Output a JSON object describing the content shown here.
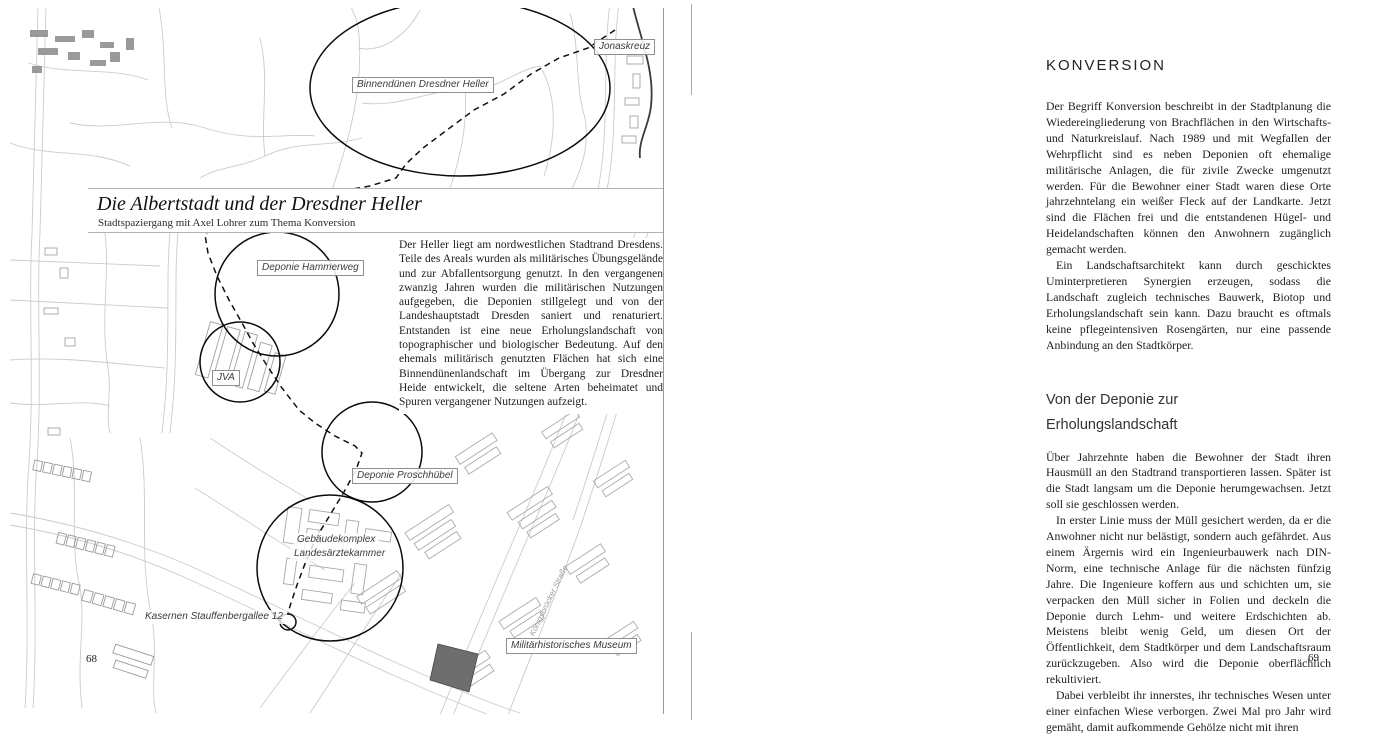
{
  "book": {
    "left_page": {
      "page_number": "68",
      "title": "Die Albertstadt und der Dresdner Heller",
      "subtitle": "Stadtspaziergang mit Axel Lohrer zum Thema Konversion",
      "intro": "Der Heller liegt am nordwestlichen Stadtrand Dresdens. Teile des Areals wurden als militärisches Übungsgelände und zur Abfallentsorgung genutzt. In den vergangenen zwanzig Jahren wurden die militärischen Nutzungen aufgegeben, die Deponien stillgelegt und von der Landeshauptstadt Dresden saniert und renaturiert. Entstanden ist eine neue Erholungslandschaft von topographischer und biologischer Bedeutung. Auf den ehemals militärisch genutzten Flächen hat sich eine Binnendünenlandschaft im Übergang zur Dresdner Heide entwickelt, die seltene Arten beheimatet und Spuren vergangener Nutzungen aufzeigt.",
      "map": {
        "labels": [
          {
            "text": "Jonaskreuz"
          },
          {
            "text": "Binnendünen Dresdner Heller"
          },
          {
            "text": "Deponie Hammerweg"
          },
          {
            "text": "JVA"
          },
          {
            "text": "Deponie Proschhübel"
          },
          {
            "text": "Gebäudekomplex"
          },
          {
            "text": "Landesärztekammer"
          },
          {
            "text": "Kasernen Stauffenbergallee 12"
          },
          {
            "text": "Militärhistorisches Museum"
          }
        ],
        "street_label": "Königsbrücker Straße"
      }
    },
    "right_page": {
      "page_number": "69",
      "section1": {
        "heading": "KONVERSION",
        "paragraphs": [
          "Der Begriff Konversion beschreibt in der Stadtplanung die Wiedereingliederung von Brachflächen in den Wirtschafts- und Naturkreislauf. Nach 1989 und mit Wegfallen der Wehrpflicht sind es neben Deponien oft ehemalige militärische Anlagen, die für zivile Zwecke umgenutzt werden. Für die Bewohner einer Stadt waren diese Orte jahrzehntelang ein weißer Fleck auf der Landkarte. Jetzt sind die Flächen frei und die entstandenen Hügel- und Heidelandschaften können den Anwohnern zugänglich gemacht werden.",
          "Ein Landschaftsarchitekt kann durch geschicktes Uminterpretieren Synergien erzeugen, sodass die Landschaft zugleich technisches Bauwerk, Biotop und Erholungslandschaft sein kann. Dazu braucht es oftmals keine pflegeintensiven Rosengärten, nur eine passende Anbindung an den Stadtkörper."
        ]
      },
      "section2": {
        "heading_line1": "Von der Deponie zur",
        "heading_line2": "Erholungslandschaft",
        "paragraphs": [
          "Über Jahrzehnte haben die Bewohner der Stadt ihren Hausmüll an den Stadtrand transportieren lassen. Später ist die Stadt langsam um die Deponie herumgewachsen. Jetzt soll sie geschlossen werden.",
          "In erster Linie muss der Müll gesichert werden, da er die Anwohner nicht nur belästigt, sondern auch gefährdet. Aus einem Ärgernis wird ein Ingenieurbauwerk nach DIN-Norm, eine technische Anlage für die nächsten fünfzig Jahre. Die Ingenieure koffern aus und schichten um, sie verpacken den Müll sicher in Folien und deckeln die Deponie durch Lehm- und weitere Erdschichten ab. Meistens bleibt wenig Geld, um diesen Ort der Öffentlichkeit, dem Stadtkörper und dem Landschaftsraum zurückzugeben. Also wird die Deponie oberflächlich rekultiviert.",
          "Dabei verbleibt ihr innerstes, ihr technisches Wesen unter einer einfachen Wiese verborgen. Zwei Mal pro Jahr wird gemäht, damit aufkommende Gehölze nicht mit ihren"
        ]
      }
    }
  }
}
